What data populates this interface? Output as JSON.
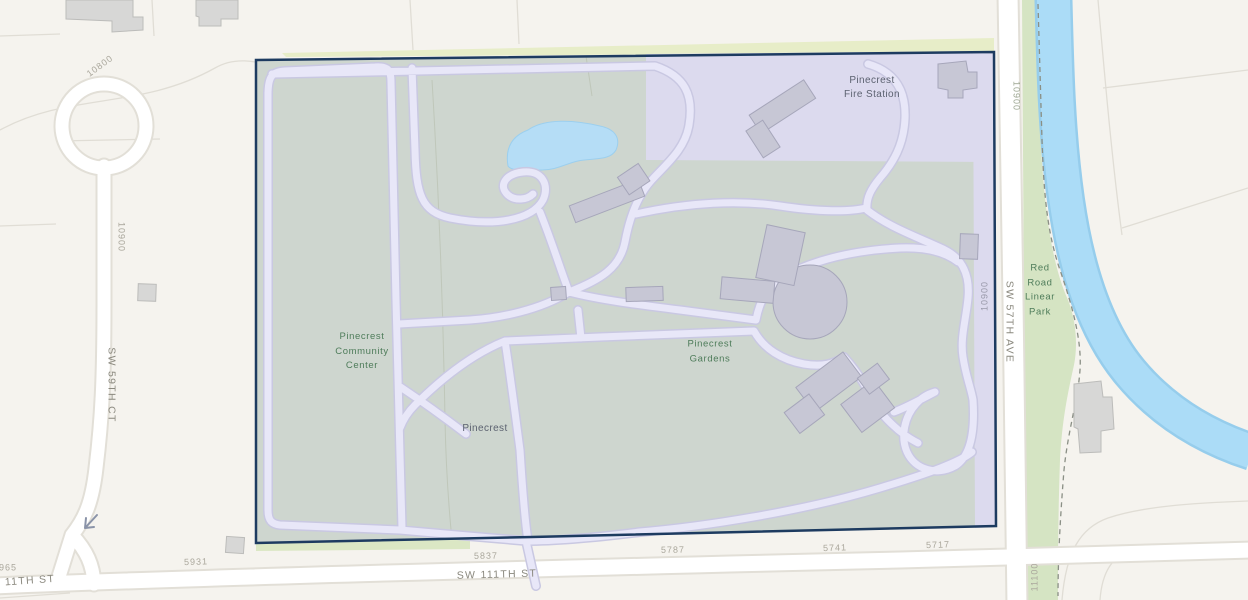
{
  "places": {
    "fire_station": "Pinecrest\nFire Station",
    "community_center": "Pinecrest\nCommunity\nCenter",
    "gardens": "Pinecrest\nGardens",
    "pinecrest": "Pinecrest",
    "red_road_park": "Red\nRoad\nLinear\nPark"
  },
  "streets": {
    "sw_59th_ct": "SW 59TH CT",
    "sw_111th_st": "SW 111TH ST",
    "sw_111th_st_left": "11TH ST",
    "sw_57th_ave": "SW 57TH AVE"
  },
  "addresses": {
    "n10800": "10800",
    "n10900_west": "10900",
    "n10900_parcel": "10900",
    "n10900_east": "10900",
    "n11100": "11100",
    "n5931": "5931",
    "n5837": "5837",
    "n5787": "5787",
    "n5741": "5741",
    "n5717": "5717",
    "n965": "965"
  },
  "colors": {
    "park_boundary": "#1d3b60",
    "park_fill": "#ced6cf",
    "highlight_parcel": "#dcdaee",
    "water": "#abdcf7",
    "walkway": "#e8e7f8",
    "road": "#ffffff",
    "green_space": "#d5e4c3",
    "label_green": "#4e7c5a",
    "label_dark": "#5c6270",
    "label_street": "#8b897f",
    "label_address": "#aaa79c"
  }
}
